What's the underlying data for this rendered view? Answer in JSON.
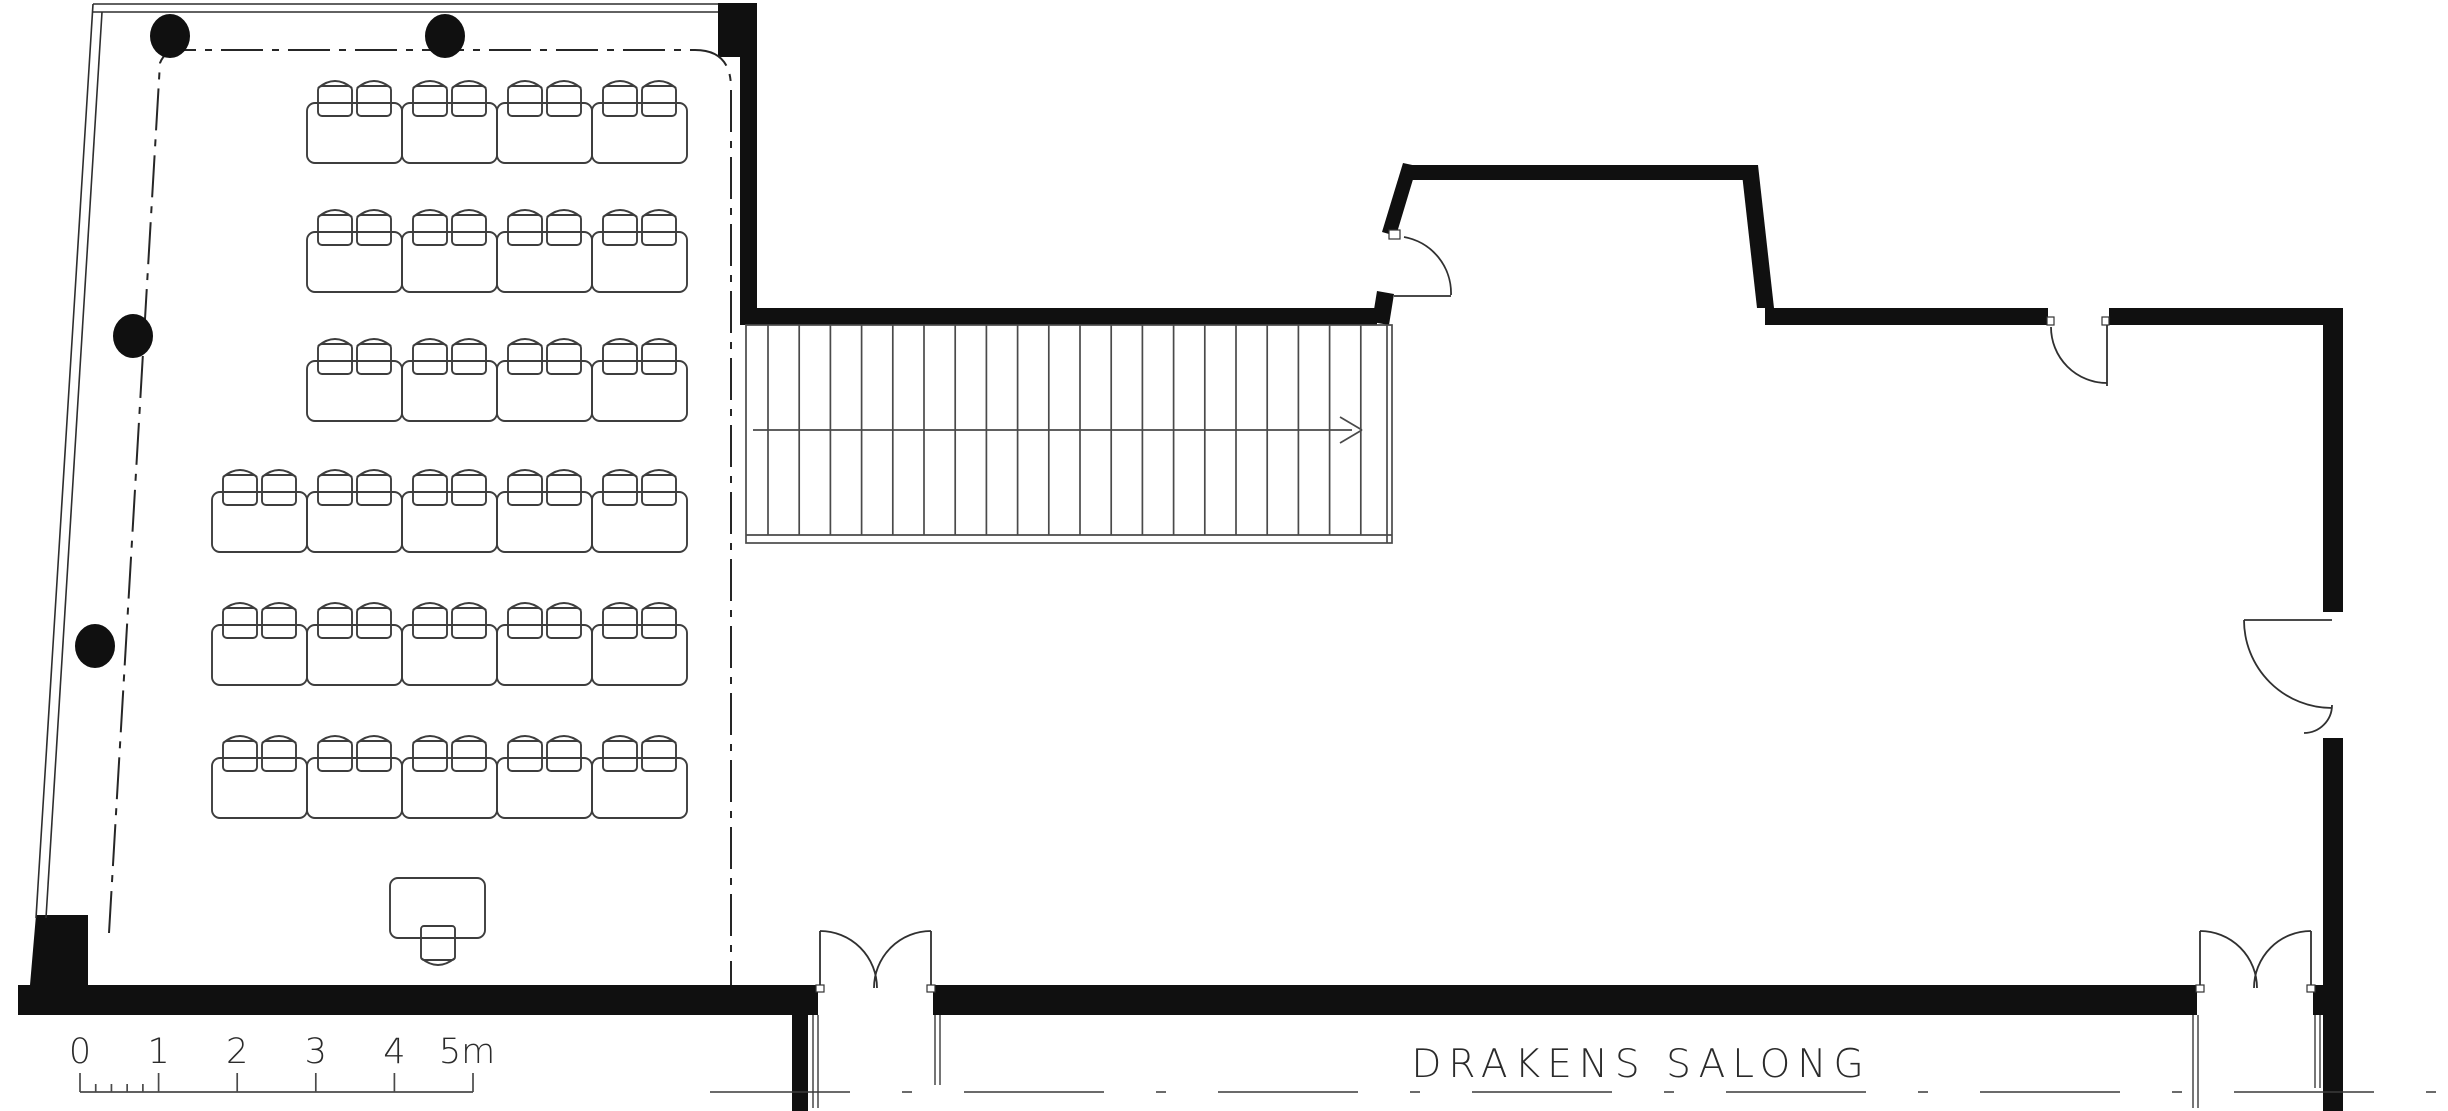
{
  "plan": {
    "title": "DRAKENS SALONG",
    "drawing_type": "floor-plan",
    "scale_bar": {
      "labels": [
        "0",
        "1",
        "2",
        "3",
        "4",
        "5m"
      ],
      "unit": "m",
      "major_divisions": 5,
      "minor_divisions_first_segment": 5
    },
    "stairs": {
      "tread_count": 20,
      "direction": "right"
    },
    "seating": {
      "rows": [
        {
          "tables": 4
        },
        {
          "tables": 4
        },
        {
          "tables": 4
        },
        {
          "tables": 5
        },
        {
          "tables": 5
        },
        {
          "tables": 5
        }
      ],
      "chairs_per_table": 2,
      "total_tables": 27,
      "total_chairs": 54
    },
    "lectern": {
      "chairs": 1
    },
    "structural_columns": 4,
    "doors": {
      "single_doors": 3,
      "double_doors": 2
    },
    "colors": {
      "ink": "#101010",
      "paper": "#ffffff",
      "line": "#3d3d3d"
    }
  }
}
